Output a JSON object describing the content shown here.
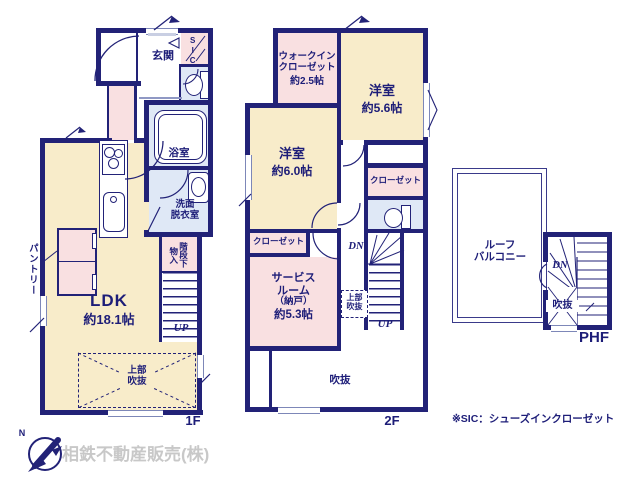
{
  "meta": {
    "floor1_label": "1F",
    "floor2_label": "2F",
    "phf_label": "PHF",
    "footnote": "※SIC：シューズインクローゼット",
    "company": "相鉄不動産販売(株)",
    "compass_n": "N"
  },
  "f1": {
    "genkan": "玄関",
    "sic": "SIC",
    "bath": "浴室",
    "wash_line1": "洗面",
    "wash_line2": "脱衣室",
    "pantry": "パントリー",
    "storage_line1": "階段下",
    "storage_line2": "物入",
    "ldk_name": "LDK",
    "ldk_size": "約18.1帖",
    "void_line1": "上部",
    "void_line2": "吹抜",
    "up": "UP"
  },
  "f2": {
    "wic_line1": "ウォークイン",
    "wic_line2": "クローゼット",
    "wic_size": "約2.5帖",
    "west1_name": "洋室",
    "west1_size": "約5.6帖",
    "west2_name": "洋室",
    "west2_size": "約6.0帖",
    "closet_right": "クローゼット",
    "closet_left": "クローゼット",
    "svc_line1": "サービス",
    "svc_line2": "ルーム",
    "svc_line3": "（納戸）",
    "svc_size": "約5.3帖",
    "void_upper_line1": "上部",
    "void_upper_line2": "吹抜",
    "void": "吹抜",
    "dn": "DN",
    "up": "UP"
  },
  "phf": {
    "roof_line1": "ルーフ",
    "roof_line2": "バルコニー",
    "void": "吹抜",
    "dn": "DN"
  },
  "colors": {
    "wall": "#222277",
    "room_cream": "#f8ecca",
    "room_pink": "#f9e0e1",
    "room_blue": "#dfe8f6",
    "company_gray": "#c8c8c8"
  }
}
